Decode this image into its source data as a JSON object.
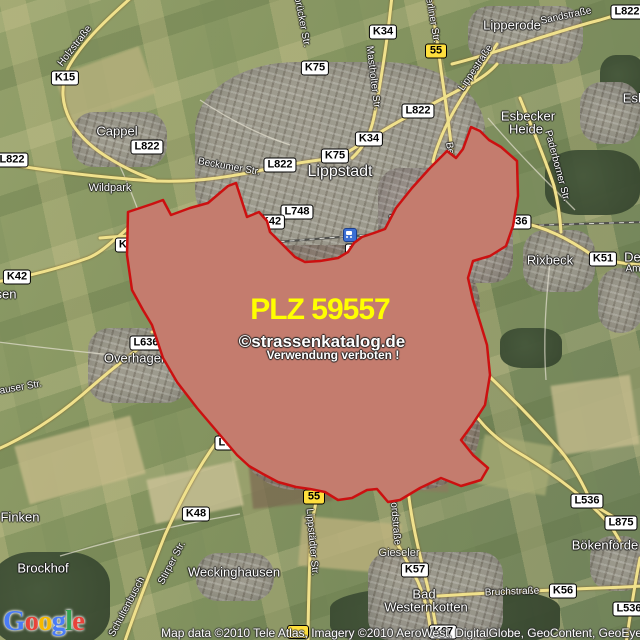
{
  "overlay": {
    "plz_label": "PLZ 59557",
    "plz_color": "#ffff00",
    "watermark": "©strassenkatalog.de",
    "watermark_note": "Verwendung verboten !",
    "boundary_color": "#cc1010",
    "fill_color": "#c98e7e"
  },
  "attribution": {
    "logo": "Google",
    "logo_colors": [
      "#4a7cf6",
      "#e8433a",
      "#f6b900",
      "#4a7cf6",
      "#34a353",
      "#e8433a"
    ],
    "text": "Map data ©2010 Tele Atlas, Imagery ©2010 AeroWest, DigitalGlobe, GeoContent, GeoEye"
  },
  "badges": [
    {
      "t": "K15",
      "x": 65,
      "y": 78,
      "v": "w"
    },
    {
      "t": "L822",
      "x": 627,
      "y": 12,
      "v": "w"
    },
    {
      "t": "K34",
      "x": 383,
      "y": 32,
      "v": "w"
    },
    {
      "t": "55",
      "x": 436,
      "y": 51,
      "v": "y"
    },
    {
      "t": "K75",
      "x": 315,
      "y": 68,
      "v": "w"
    },
    {
      "t": "L822",
      "x": 418,
      "y": 111,
      "v": "w"
    },
    {
      "t": "K34",
      "x": 369,
      "y": 139,
      "v": "w"
    },
    {
      "t": "L822",
      "x": 147,
      "y": 147,
      "v": "w"
    },
    {
      "t": "K75",
      "x": 335,
      "y": 156,
      "v": "w"
    },
    {
      "t": "L822",
      "x": 280,
      "y": 165,
      "v": "w"
    },
    {
      "t": "L822",
      "x": 12,
      "y": 160,
      "v": "w"
    },
    {
      "t": "L748",
      "x": 297,
      "y": 212,
      "v": "w"
    },
    {
      "t": "K42",
      "x": 271,
      "y": 222,
      "v": "w"
    },
    {
      "t": "55",
      "x": 463,
      "y": 213,
      "v": "o"
    },
    {
      "t": "L636",
      "x": 515,
      "y": 222,
      "v": "w"
    },
    {
      "t": "K51",
      "x": 603,
      "y": 259,
      "v": "w"
    },
    {
      "t": "K42",
      "x": 129,
      "y": 245,
      "v": "w"
    },
    {
      "t": "K42",
      "x": 17,
      "y": 277,
      "v": "w"
    },
    {
      "t": "K57",
      "x": 359,
      "y": 251,
      "v": "w"
    },
    {
      "t": "L536",
      "x": 349,
      "y": 279,
      "v": "w"
    },
    {
      "t": "55",
      "x": 449,
      "y": 285,
      "v": "o"
    },
    {
      "t": "L636",
      "x": 307,
      "y": 311,
      "v": "w"
    },
    {
      "t": "L748",
      "x": 292,
      "y": 326,
      "v": "w"
    },
    {
      "t": "L636",
      "x": 146,
      "y": 343,
      "v": "w"
    },
    {
      "t": "L536",
      "x": 443,
      "y": 336,
      "v": "w"
    },
    {
      "t": "L748",
      "x": 231,
      "y": 443,
      "v": "w"
    },
    {
      "t": "55",
      "x": 314,
      "y": 497,
      "v": "y"
    },
    {
      "t": "K48",
      "x": 196,
      "y": 514,
      "v": "w"
    },
    {
      "t": "L536",
      "x": 587,
      "y": 501,
      "v": "w"
    },
    {
      "t": "L875",
      "x": 621,
      "y": 523,
      "v": "w"
    },
    {
      "t": "K57",
      "x": 415,
      "y": 570,
      "v": "w"
    },
    {
      "t": "K56",
      "x": 563,
      "y": 591,
      "v": "w"
    },
    {
      "t": "L536",
      "x": 629,
      "y": 609,
      "v": "w"
    },
    {
      "t": "K67",
      "x": 443,
      "y": 632,
      "v": "w"
    },
    {
      "t": "",
      "x": 298,
      "y": 632,
      "v": "y"
    }
  ],
  "places": [
    {
      "t": "Lipperode",
      "x": 512,
      "y": 25
    },
    {
      "t": "Cappel",
      "x": 117,
      "y": 131
    },
    {
      "t": "Lippstadt",
      "x": 340,
      "y": 172,
      "c": "big"
    },
    {
      "t": "Esbecker",
      "x": 528,
      "y": 116
    },
    {
      "t": "Heide",
      "x": 526,
      "y": 129
    },
    {
      "t": "Esb",
      "x": 634,
      "y": 98
    },
    {
      "t": "Wildpark",
      "x": 110,
      "y": 188,
      "c": "small"
    },
    {
      "t": "Rixbeck",
      "x": 550,
      "y": 260
    },
    {
      "t": "Ded",
      "x": 636,
      "y": 257
    },
    {
      "t": "sen",
      "x": 6,
      "y": 294
    },
    {
      "t": "Overhagen",
      "x": 136,
      "y": 358
    },
    {
      "t": "Finken",
      "x": 20,
      "y": 517
    },
    {
      "t": "Brockhof",
      "x": 43,
      "y": 568
    },
    {
      "t": "Weckinghausen",
      "x": 234,
      "y": 572
    },
    {
      "t": "Gieseler",
      "x": 399,
      "y": 553,
      "c": "faint"
    },
    {
      "t": "Bad",
      "x": 424,
      "y": 594
    },
    {
      "t": "Westernkotten",
      "x": 426,
      "y": 607
    },
    {
      "t": "Bökenförde",
      "x": 605,
      "y": 545
    }
  ],
  "streets": [
    {
      "t": "Holzstraße",
      "x": 75,
      "y": 46,
      "r": -52
    },
    {
      "t": "Sandstraße",
      "x": 566,
      "y": 16,
      "r": -12
    },
    {
      "t": "Lippestraße",
      "x": 476,
      "y": 68,
      "r": -56
    },
    {
      "t": "brücker Str.",
      "x": 302,
      "y": 22,
      "r": 79
    },
    {
      "t": "Mastholter Str.",
      "x": 373,
      "y": 78,
      "r": 83
    },
    {
      "t": "Berliner Str.",
      "x": 432,
      "y": 17,
      "r": 80
    },
    {
      "t": "Berliner Str.",
      "x": 453,
      "y": 168,
      "r": 80
    },
    {
      "t": "Beckumer Str.",
      "x": 229,
      "y": 167,
      "r": 10
    },
    {
      "t": "Paderborner Str.",
      "x": 557,
      "y": 166,
      "r": 75
    },
    {
      "t": "Hellinghauser Weg",
      "x": 182,
      "y": 240,
      "r": -7
    },
    {
      "t": "Rixbecker Str.",
      "x": 420,
      "y": 216,
      "r": -7
    },
    {
      "t": "Roßfeld",
      "x": 459,
      "y": 236,
      "r": -6
    },
    {
      "t": "Roßfeld",
      "x": 417,
      "y": 243,
      "r": -10
    },
    {
      "t": "Stirper Str.",
      "x": 286,
      "y": 277,
      "r": 85
    },
    {
      "t": "Südstraße",
      "x": 340,
      "y": 321,
      "r": -8
    },
    {
      "t": "Overhagener Str.",
      "x": 233,
      "y": 326,
      "r": -3
    },
    {
      "t": "Erwitter Str.",
      "x": 320,
      "y": 379,
      "r": 95
    },
    {
      "t": "Erwitter Str.",
      "x": 316,
      "y": 457,
      "r": 97
    },
    {
      "t": "Berliner Str.",
      "x": 350,
      "y": 397,
      "r": -42
    },
    {
      "t": "Westernkötter Str.",
      "x": 400,
      "y": 442,
      "r": 87
    },
    {
      "t": "Bökenförder Str.",
      "x": 454,
      "y": 379,
      "r": 68
    },
    {
      "t": "Nordstraße",
      "x": 395,
      "y": 520,
      "r": 85
    },
    {
      "t": "Lippstädter Str.",
      "x": 312,
      "y": 542,
      "r": 85
    },
    {
      "t": "Stirper Str.",
      "x": 260,
      "y": 409,
      "r": -45
    },
    {
      "t": "Stirper Str.",
      "x": 172,
      "y": 563,
      "r": -62
    },
    {
      "t": "Schultenbusch",
      "x": 127,
      "y": 607,
      "r": -62
    },
    {
      "t": "hauser Str.",
      "x": 18,
      "y": 388,
      "r": -10
    },
    {
      "t": "Bruchstraße",
      "x": 512,
      "y": 592,
      "r": -2
    },
    {
      "t": "Am",
      "x": 633,
      "y": 269,
      "r": 0
    }
  ],
  "icons": [
    {
      "name": "train-station-icon",
      "x": 350,
      "y": 235
    }
  ]
}
